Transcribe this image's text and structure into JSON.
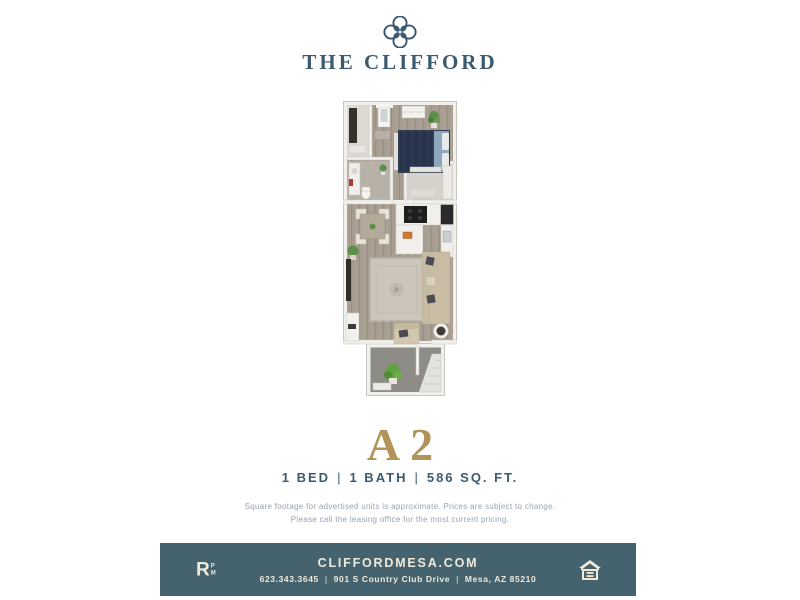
{
  "brand": {
    "name": "THE CLIFFORD",
    "emblem_icon": "quatrefoil-icon",
    "color_primary": "#3b5a70",
    "color_gold": "#b2945a",
    "color_cream": "#f0e9d8",
    "color_footer_bg": "#44636f"
  },
  "unit": {
    "name": "A2",
    "bed": "1 BED",
    "bath": "1 BATH",
    "sqft": "586 SQ. FT.",
    "separator": "|",
    "disclaimer_line1": "Square footage for advertised units is approximate. Prices are subject to change.",
    "disclaimer_line2": "Please call the leasing office for the most current pricing."
  },
  "floorplan": {
    "description": "3D top-down rendering of 1-bedroom apartment: bedroom with bed and closet at top, bathroom and walk-in closet mid, kitchen with dining area, living room with sectional sofa and rug, balcony with stairs at bottom"
  },
  "footer": {
    "website": "CLIFFORDMESA.COM",
    "phone": "623.343.3645",
    "address": "901 S Country Club Drive",
    "city_state_zip": "Mesa, AZ 85210",
    "separator": "|",
    "management_logo": {
      "letter": "R",
      "small_top": "P",
      "small_bottom": "M"
    },
    "equal_housing_icon": "equal-housing-icon"
  }
}
